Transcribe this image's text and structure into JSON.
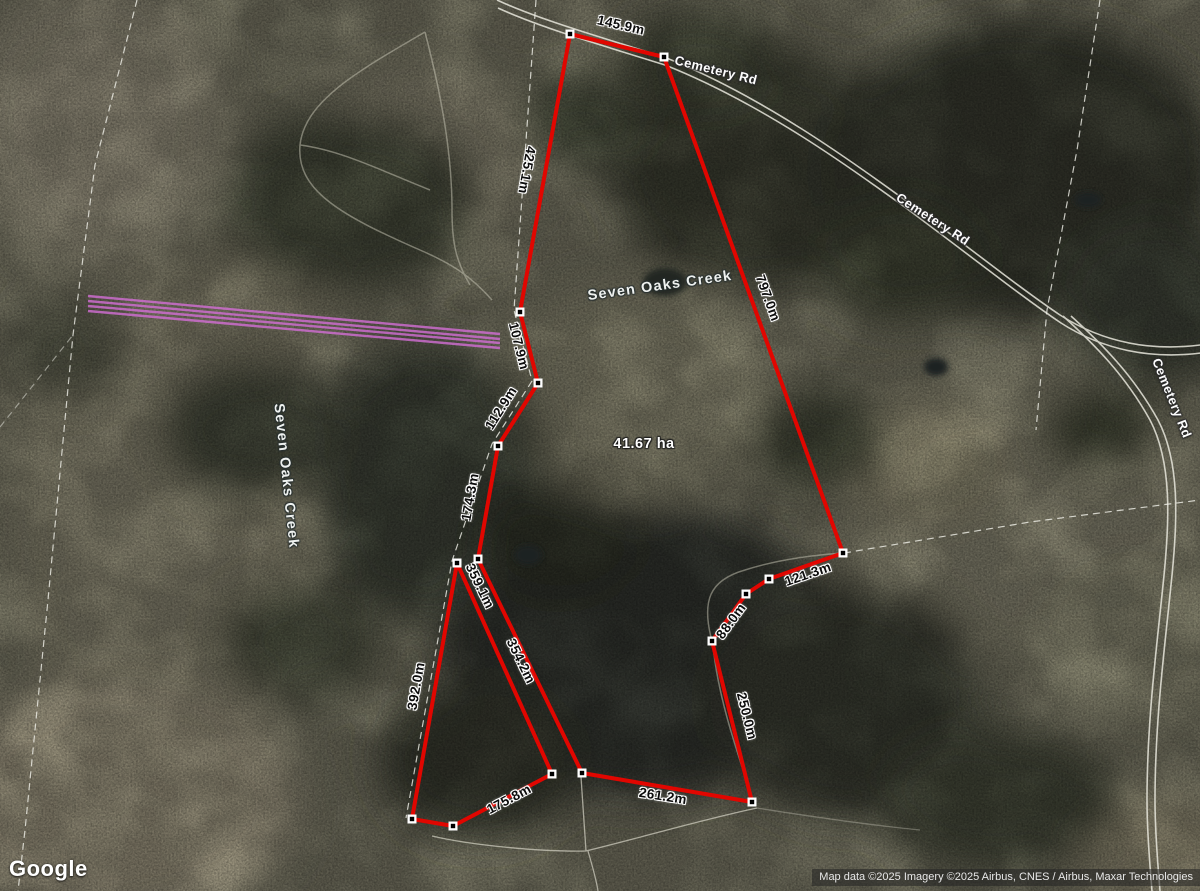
{
  "map": {
    "logo": "Google",
    "attribution": "Map data ©2025 Imagery ©2025 Airbus, CNES / Airbus, Maxar Technologies",
    "area_label": "41.67 ha",
    "area_label_pos": {
      "x": 644,
      "y": 444
    },
    "road_labels": [
      {
        "text": "Cemetery Rd",
        "x": 716,
        "y": 70,
        "rot": 14
      },
      {
        "text": "Cemetery Rd",
        "x": 933,
        "y": 219,
        "rot": 33
      },
      {
        "text": "Cemetery Rd",
        "x": 1172,
        "y": 398,
        "rot": 68
      }
    ],
    "water_labels": [
      {
        "text": "Seven Oaks Creek",
        "x": 660,
        "y": 286,
        "rot": -8
      },
      {
        "text": "Seven Oaks Creek",
        "x": 286,
        "y": 476,
        "rot": 84
      }
    ],
    "measurement_labels": [
      {
        "text": "145.9m",
        "x": 621,
        "y": 25,
        "rot": 13
      },
      {
        "text": "425.1m",
        "x": 527,
        "y": 170,
        "rot": 100
      },
      {
        "text": "107.9m",
        "x": 519,
        "y": 346,
        "rot": 76
      },
      {
        "text": "112.9m",
        "x": 501,
        "y": 408,
        "rot": -58
      },
      {
        "text": "174.3m",
        "x": 470,
        "y": 497,
        "rot": -80
      },
      {
        "text": "359.1m",
        "x": 480,
        "y": 586,
        "rot": 64
      },
      {
        "text": "354.2m",
        "x": 521,
        "y": 661,
        "rot": 64
      },
      {
        "text": "392.0m",
        "x": 416,
        "y": 686,
        "rot": -80
      },
      {
        "text": "175.8m",
        "x": 509,
        "y": 799,
        "rot": -28
      },
      {
        "text": "261.2m",
        "x": 663,
        "y": 796,
        "rot": 9
      },
      {
        "text": "250.0m",
        "x": 747,
        "y": 716,
        "rot": 76
      },
      {
        "text": "88.0m",
        "x": 731,
        "y": 621,
        "rot": -54
      },
      {
        "text": "121.3m",
        "x": 808,
        "y": 574,
        "rot": -19
      },
      {
        "text": "797.0m",
        "x": 768,
        "y": 298,
        "rot": 70
      }
    ],
    "parcels": {
      "main": [
        [
          570,
          34
        ],
        [
          664,
          57
        ],
        [
          843,
          553
        ],
        [
          769,
          579
        ],
        [
          746,
          594
        ],
        [
          712,
          641
        ],
        [
          752,
          802
        ],
        [
          582,
          773
        ],
        [
          478,
          559
        ],
        [
          498,
          446
        ],
        [
          538,
          383
        ],
        [
          520,
          312
        ]
      ],
      "sliver": [
        [
          457,
          563
        ],
        [
          552,
          774
        ],
        [
          453,
          826
        ],
        [
          412,
          819
        ]
      ]
    },
    "powerline": {
      "lines": [
        [
          88,
          296,
          500,
          334
        ],
        [
          88,
          301,
          500,
          339
        ],
        [
          88,
          306,
          500,
          343
        ],
        [
          88,
          311,
          500,
          348
        ]
      ]
    },
    "colors": {
      "boundary": "#e10600",
      "vertex_fill": "#ffffff",
      "vertex_core": "#000000",
      "powerline": "#d46fd6"
    }
  }
}
